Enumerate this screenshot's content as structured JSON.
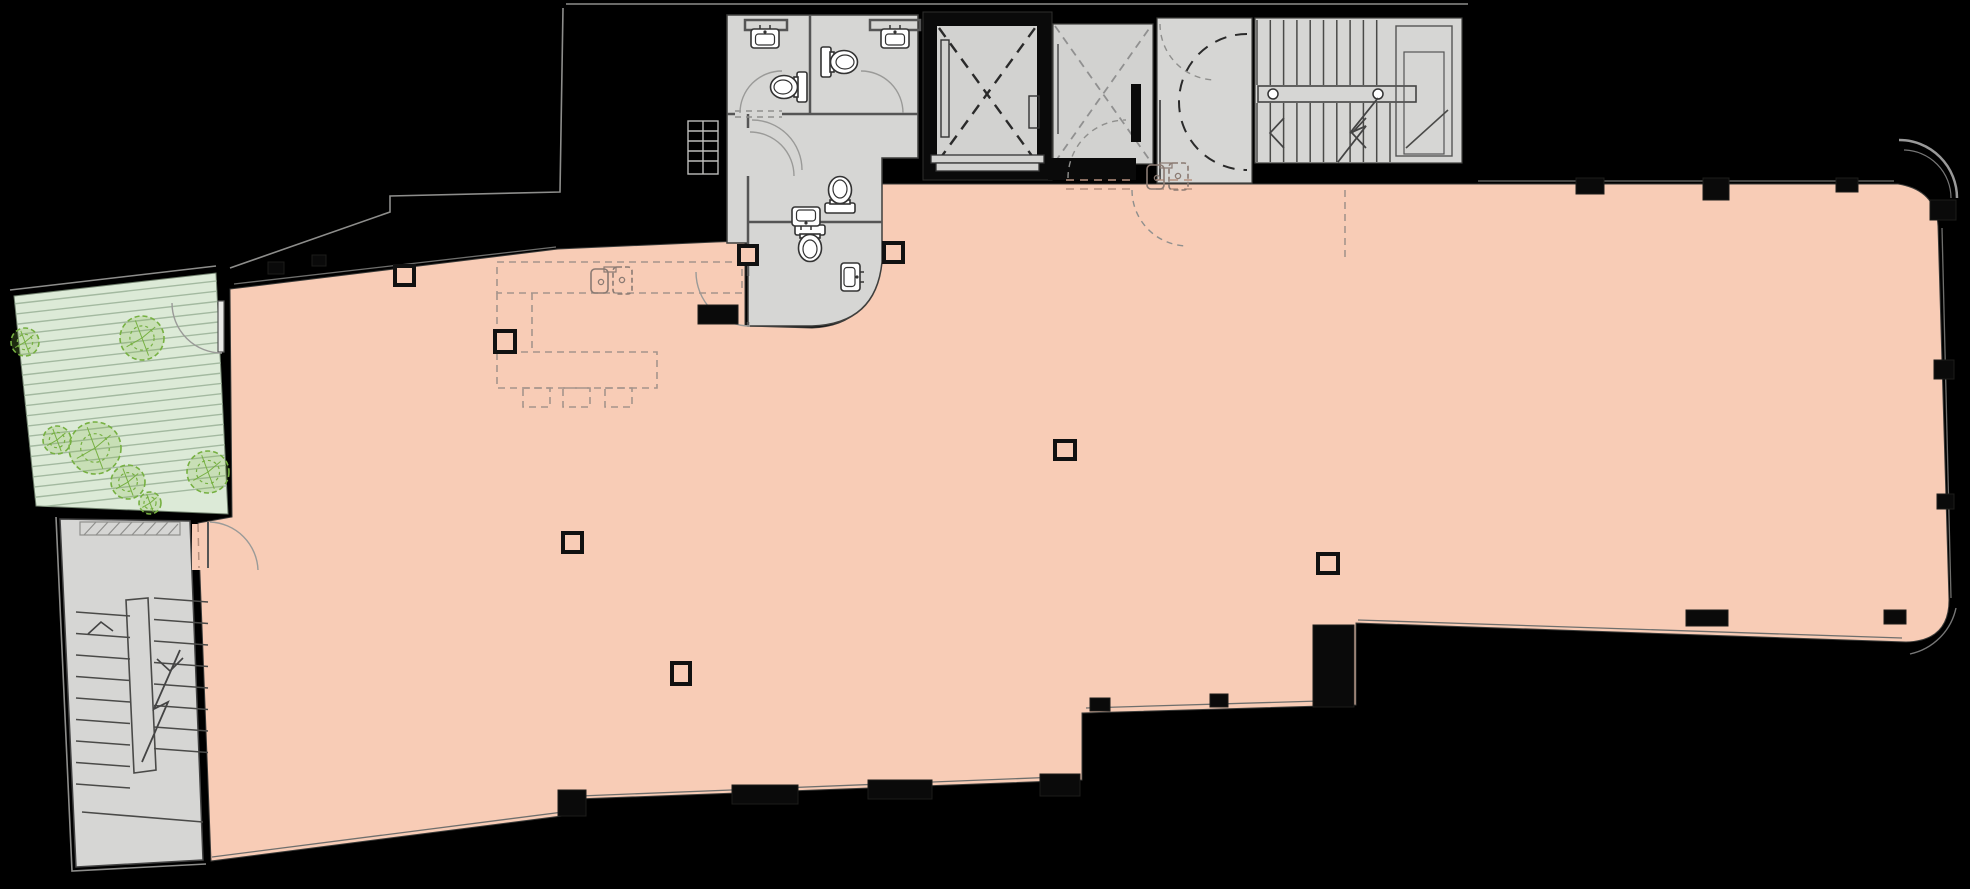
{
  "diagram": {
    "type": "architectural-floor-plan",
    "title": "Open floor plate with terrace, core, elevators and stairs",
    "has_text_labels": false
  },
  "colors": {
    "bg": "#000000",
    "floor": "#f8ccb6",
    "floor_edge": "#3a3a38",
    "room_gray": "#d6d6d4",
    "elevator_gray": "#d2d2d0",
    "wall_dark": "#0a0a0a",
    "terrace_fill": "#dcead7",
    "terrace_stripe": "#a3b9a0",
    "plant_stroke": "#76b041",
    "plant_fill": "rgba(130,185,70,0.22)",
    "dark_dash": "#2a2a2a",
    "light_dash": "#909090"
  },
  "areas": [
    {
      "name": "open-floor",
      "color_key": "floor"
    },
    {
      "name": "roof-terrace",
      "color_key": "terrace_fill"
    },
    {
      "name": "south-stairwell",
      "color_key": "room_gray"
    },
    {
      "name": "north-stairwell",
      "color_key": "room_gray"
    },
    {
      "name": "wc-cluster",
      "color_key": "room_gray"
    },
    {
      "name": "elevator-shaft-1",
      "color_key": "elevator_gray"
    },
    {
      "name": "elevator-shaft-2",
      "color_key": "elevator_gray"
    },
    {
      "name": "core-lobby",
      "color_key": "room_gray"
    }
  ],
  "fixtures": {
    "toilets": [
      {
        "cx": 790,
        "cy": 87,
        "rot": 90
      },
      {
        "cx": 838,
        "cy": 62,
        "rot": -90
      },
      {
        "cx": 840,
        "cy": 196,
        "rot": 180
      },
      {
        "cx": 810,
        "cy": 242,
        "rot": 0
      }
    ],
    "wall_sinks": [
      {
        "cx": 765,
        "cy": 39,
        "rot": 0
      },
      {
        "cx": 895,
        "cy": 39,
        "rot": 0
      },
      {
        "cx": 806,
        "cy": 216,
        "rot": 180
      },
      {
        "cx": 850,
        "cy": 277,
        "rot": 90
      }
    ],
    "kitchen_sinks": [
      {
        "cx": 612,
        "cy": 280
      },
      {
        "cx": 1168,
        "cy": 176
      }
    ]
  },
  "kitchen": {
    "counter": {
      "x": 497,
      "y": 262,
      "w": 245,
      "h": 31
    },
    "island": {
      "x": 497,
      "y": 352,
      "w": 160,
      "h": 36
    },
    "peninsula_lines": [
      [
        497,
        293,
        497,
        352
      ],
      [
        532,
        293,
        532,
        352
      ],
      [
        1345,
        190,
        1345,
        258
      ]
    ],
    "stools": [
      {
        "x": 523,
        "y": 388,
        "w": 27,
        "h": 19
      },
      {
        "x": 563,
        "y": 388,
        "w": 27,
        "h": 19
      },
      {
        "x": 605,
        "y": 388,
        "w": 27,
        "h": 19
      }
    ]
  },
  "columns_hollow": [
    {
      "x": 395,
      "y": 266,
      "w": 19,
      "h": 19
    },
    {
      "x": 495,
      "y": 331,
      "w": 20,
      "h": 21
    },
    {
      "x": 739,
      "y": 246,
      "w": 18,
      "h": 18
    },
    {
      "x": 884,
      "y": 243,
      "w": 19,
      "h": 19
    },
    {
      "x": 563,
      "y": 533,
      "w": 19,
      "h": 19
    },
    {
      "x": 672,
      "y": 663,
      "w": 18,
      "h": 21
    },
    {
      "x": 1055,
      "y": 441,
      "w": 20,
      "h": 18
    },
    {
      "x": 1318,
      "y": 554,
      "w": 20,
      "h": 19
    }
  ],
  "wall_piers_solid": [
    {
      "x": 1576,
      "y": 178,
      "w": 28,
      "h": 16
    },
    {
      "x": 1703,
      "y": 178,
      "w": 26,
      "h": 22
    },
    {
      "x": 1836,
      "y": 178,
      "w": 22,
      "h": 14
    },
    {
      "x": 268,
      "y": 262,
      "w": 16,
      "h": 12
    },
    {
      "x": 312,
      "y": 255,
      "w": 14,
      "h": 11
    },
    {
      "x": 1930,
      "y": 200,
      "w": 26,
      "h": 20
    },
    {
      "x": 1934,
      "y": 360,
      "w": 20,
      "h": 19
    },
    {
      "x": 1937,
      "y": 494,
      "w": 17,
      "h": 15
    },
    {
      "x": 1686,
      "y": 610,
      "w": 42,
      "h": 16
    },
    {
      "x": 1884,
      "y": 610,
      "w": 22,
      "h": 14
    },
    {
      "x": 1090,
      "y": 698,
      "w": 20,
      "h": 13
    },
    {
      "x": 1210,
      "y": 694,
      "w": 18,
      "h": 13
    },
    {
      "x": 558,
      "y": 790,
      "w": 28,
      "h": 26
    },
    {
      "x": 732,
      "y": 785,
      "w": 66,
      "h": 19
    },
    {
      "x": 868,
      "y": 780,
      "w": 64,
      "h": 19
    },
    {
      "x": 1040,
      "y": 774,
      "w": 40,
      "h": 22
    },
    {
      "x": 1313,
      "y": 625,
      "w": 41,
      "h": 82
    },
    {
      "x": 698,
      "y": 305,
      "w": 40,
      "h": 19
    }
  ],
  "plants": [
    {
      "cx": 142,
      "cy": 338,
      "r": 22
    },
    {
      "cx": 95,
      "cy": 448,
      "r": 26
    },
    {
      "cx": 57,
      "cy": 440,
      "r": 14
    },
    {
      "cx": 128,
      "cy": 482,
      "r": 17
    },
    {
      "cx": 208,
      "cy": 472,
      "r": 21
    },
    {
      "cx": 150,
      "cy": 503,
      "r": 11
    },
    {
      "cx": 25,
      "cy": 342,
      "r": 14
    }
  ],
  "terrace_stripes": {
    "n": 21,
    "y0": 304,
    "dy": 10.3,
    "x1": 13,
    "x2": 234,
    "drop": -25
  },
  "north_stairs": {
    "upper": {
      "x0": 1257,
      "dx": 13.3,
      "n": 10,
      "y1": 20,
      "y2": 85
    },
    "lower": {
      "x0": 1257,
      "dx": 13.3,
      "n": 11,
      "y1": 103,
      "y2": 162
    },
    "rail_circles": [
      {
        "cx": 1273,
        "cy": 94
      },
      {
        "cx": 1378,
        "cy": 94
      }
    ]
  },
  "south_stairs": {
    "left": {
      "n": 9,
      "y0": 612,
      "dy": 21.5,
      "x1": 76,
      "x2": 130,
      "skew": 4
    },
    "right": {
      "n": 8,
      "y0": 598,
      "dy": 21.5,
      "x1": 154,
      "x2": 208,
      "skew": 4
    }
  }
}
